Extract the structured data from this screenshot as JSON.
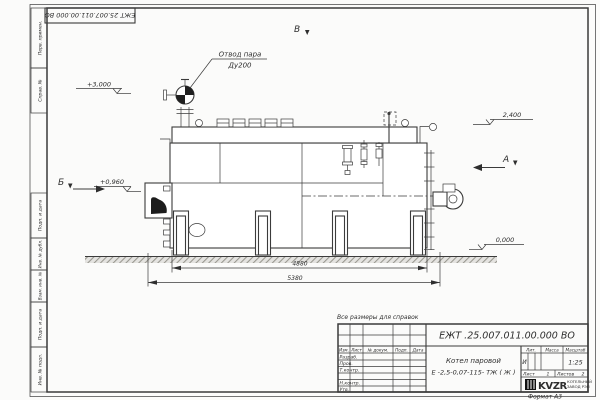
{
  "sheet": {
    "top_stamp_text": "ЕЖТ 25.007.011.00.000  ВО",
    "format_note": "Формат А3",
    "margin_labels": [
      "Перв. примен.",
      "Справ. №",
      "Подп. и дата",
      "Инв. № дубл.",
      "Взам. инв. №",
      "Подп. и дата",
      "Инв. № подл."
    ]
  },
  "drawing": {
    "callout_line1": "Отвод пара",
    "callout_line2": "Ду200",
    "view_b": "Б",
    "view_v": "В",
    "view_a": "А",
    "elev_top": "+3,000",
    "elev_mid": "+0,960",
    "elev_right": "2,400",
    "elev_zero": "0,000",
    "dim_inner": "4880",
    "dim_outer": "5380"
  },
  "note": "Все размеры для справок",
  "title_block": {
    "doc_number": "ЕЖТ .25.007.011.00.000  ВО",
    "name_line1": "Котел паровой",
    "name_line2": "Е -2,5-0,07-115- ТЖ ( Ж )",
    "col_izm": "Изм.",
    "col_list": "Лист",
    "col_doc": "№ докум.",
    "col_sign": "Подп.",
    "col_date": "Дата",
    "rows": [
      "Разраб.",
      "Пров.",
      "Т.контр.",
      "",
      "Н.контр.",
      "Утв."
    ],
    "lit_label": "Лит.",
    "lit_value": "И",
    "mass_label": "Масса",
    "scale_label": "Масштаб",
    "scale_value": "1:25",
    "sheet_label": "Лист",
    "sheet_no": "1",
    "sheets_label": "Листов",
    "sheets_no": "2",
    "logo": "KVZR",
    "logo_sub1": "КОТЕЛЬНЫЙ",
    "logo_sub2": "ЗАВОД РЭП"
  }
}
